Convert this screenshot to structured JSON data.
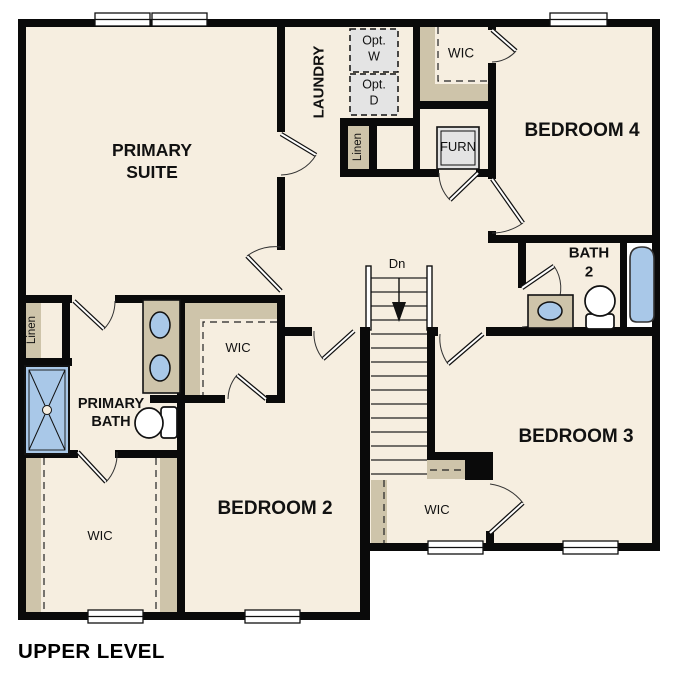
{
  "title": "UPPER LEVEL",
  "colors": {
    "wall": "#0a0a0a",
    "floor_cream": "#f6eee0",
    "shelf_tan": "#cec4aa",
    "fixture_blue": "#a9c8e8",
    "equipment_gray": "#e4e4e4",
    "window_white": "#ffffff"
  },
  "rooms": {
    "primary_suite": "PRIMARY SUITE",
    "laundry": "LAUNDRY",
    "bedroom4": "BEDROOM 4",
    "bedroom3": "BEDROOM 3",
    "bedroom2": "BEDROOM 2",
    "bath2": "BATH 2",
    "primary_bath": "PRIMARY BATH",
    "wic_top": "WIC",
    "wic_middle": "WIC",
    "wic_lower_left": "WIC",
    "wic_bedroom3": "WIC"
  },
  "closets": {
    "linen_top": "Linen",
    "linen_left": "Linen"
  },
  "equipment": {
    "furnace": "FURN",
    "opt_washer": "Opt. W",
    "opt_dryer": "Opt. D"
  },
  "stairs": {
    "direction_label": "Dn"
  }
}
